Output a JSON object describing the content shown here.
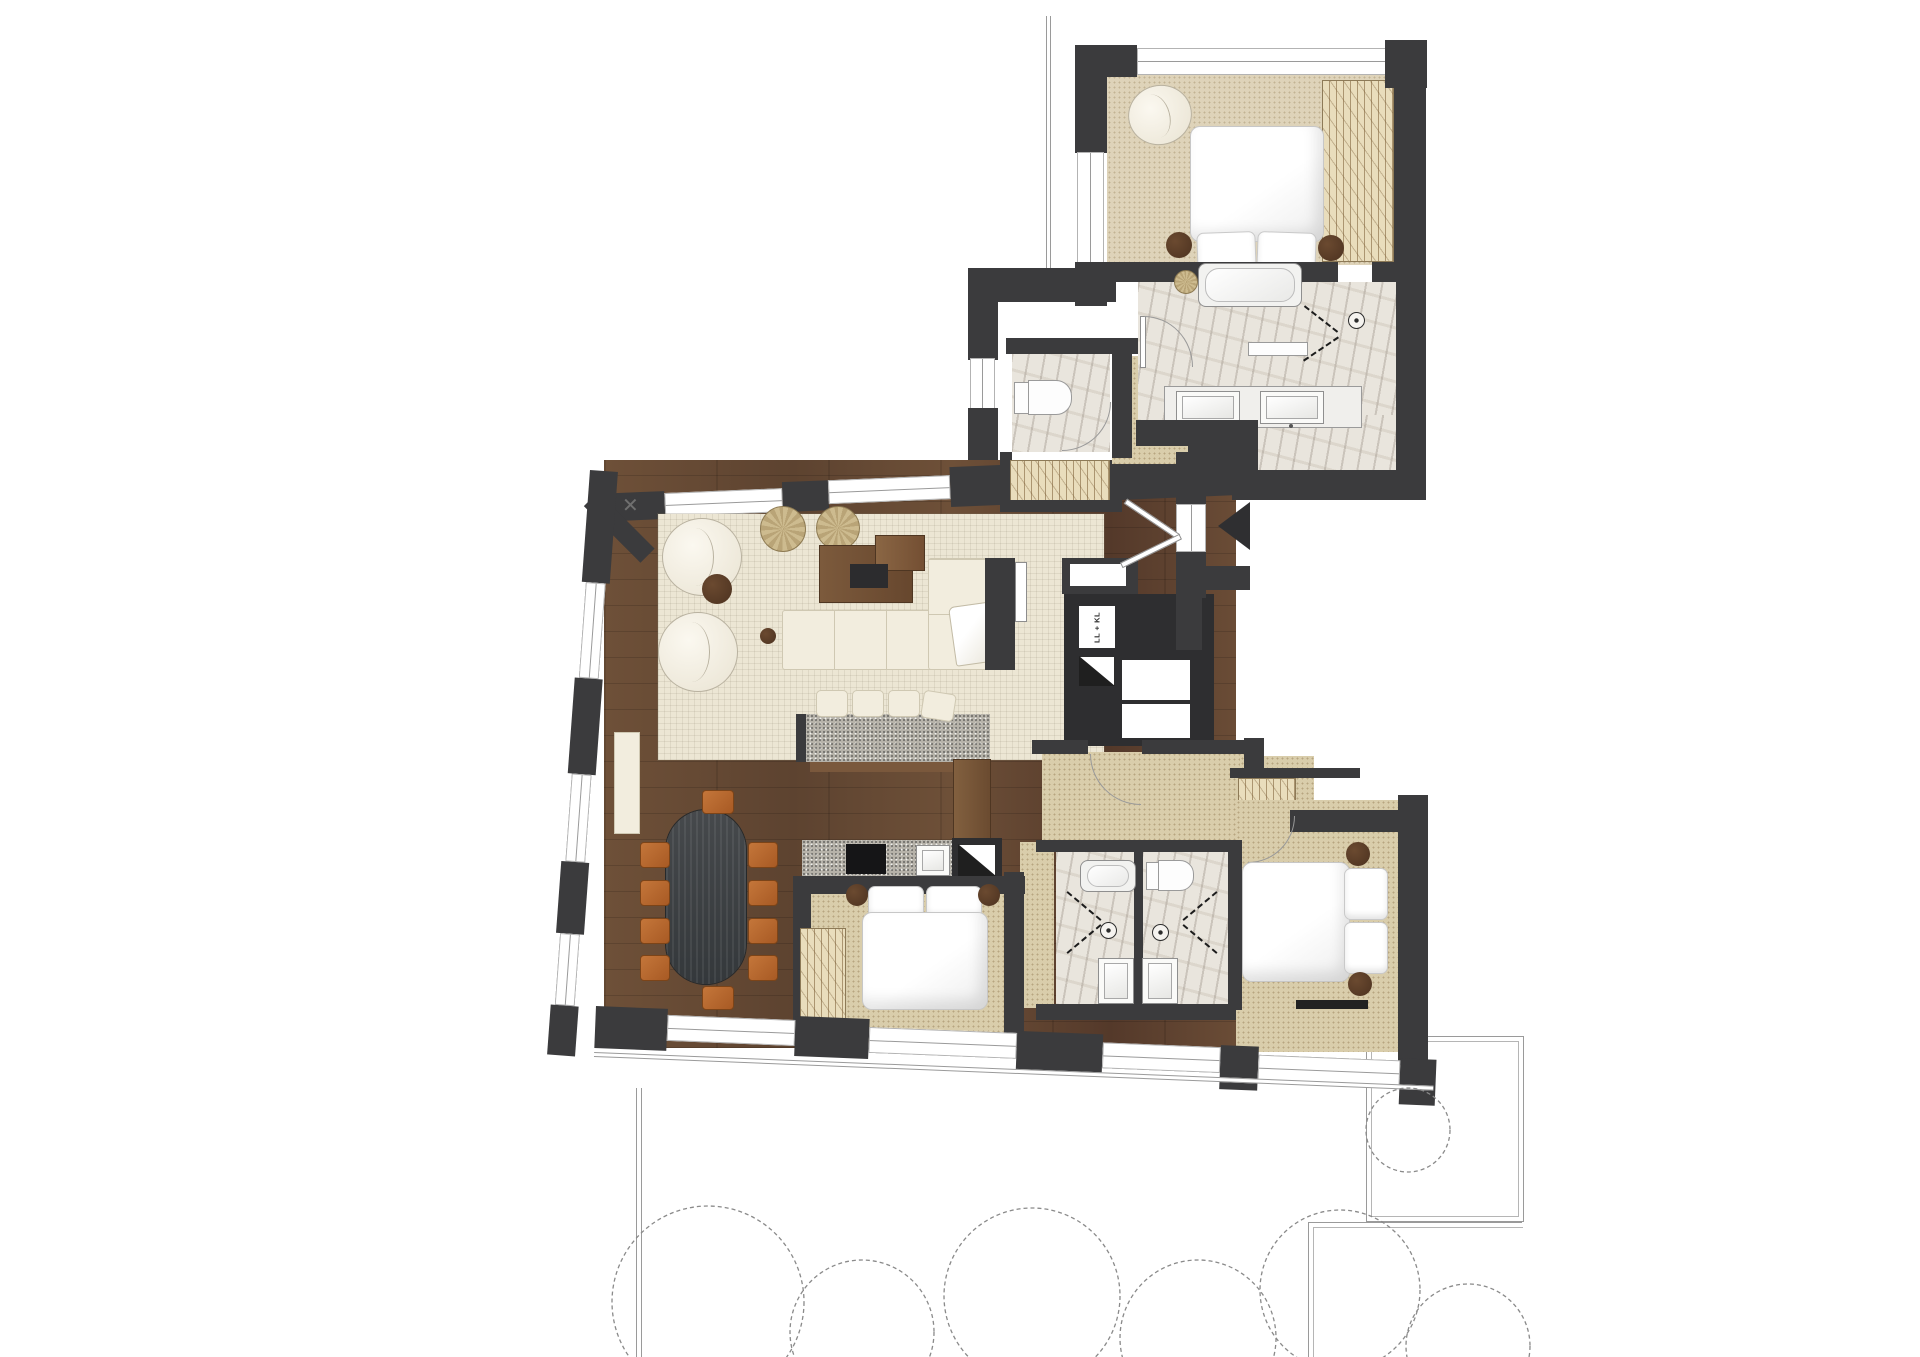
{
  "labels": {
    "shaft": "LL + KL"
  },
  "icons": {
    "sprinkler": "✕",
    "entry_arrow": "left-pointing-entrance-arrow",
    "shower_head": "concentric-circle-shower-symbol",
    "toilet": "toilet-top-view",
    "bathtub": "bathtub-top-view"
  },
  "colors": {
    "wall": "#3b3b3d",
    "wood": "#654831",
    "rug": "#ece6d4",
    "carpet": "#d9cdab",
    "marble": "#e9e5dd",
    "granite": "#b6b2a9",
    "wardrobe": "#e9ddbc",
    "leather": "#b4682f",
    "dining_table": "#43474a",
    "outline": "#9a9a9a"
  }
}
